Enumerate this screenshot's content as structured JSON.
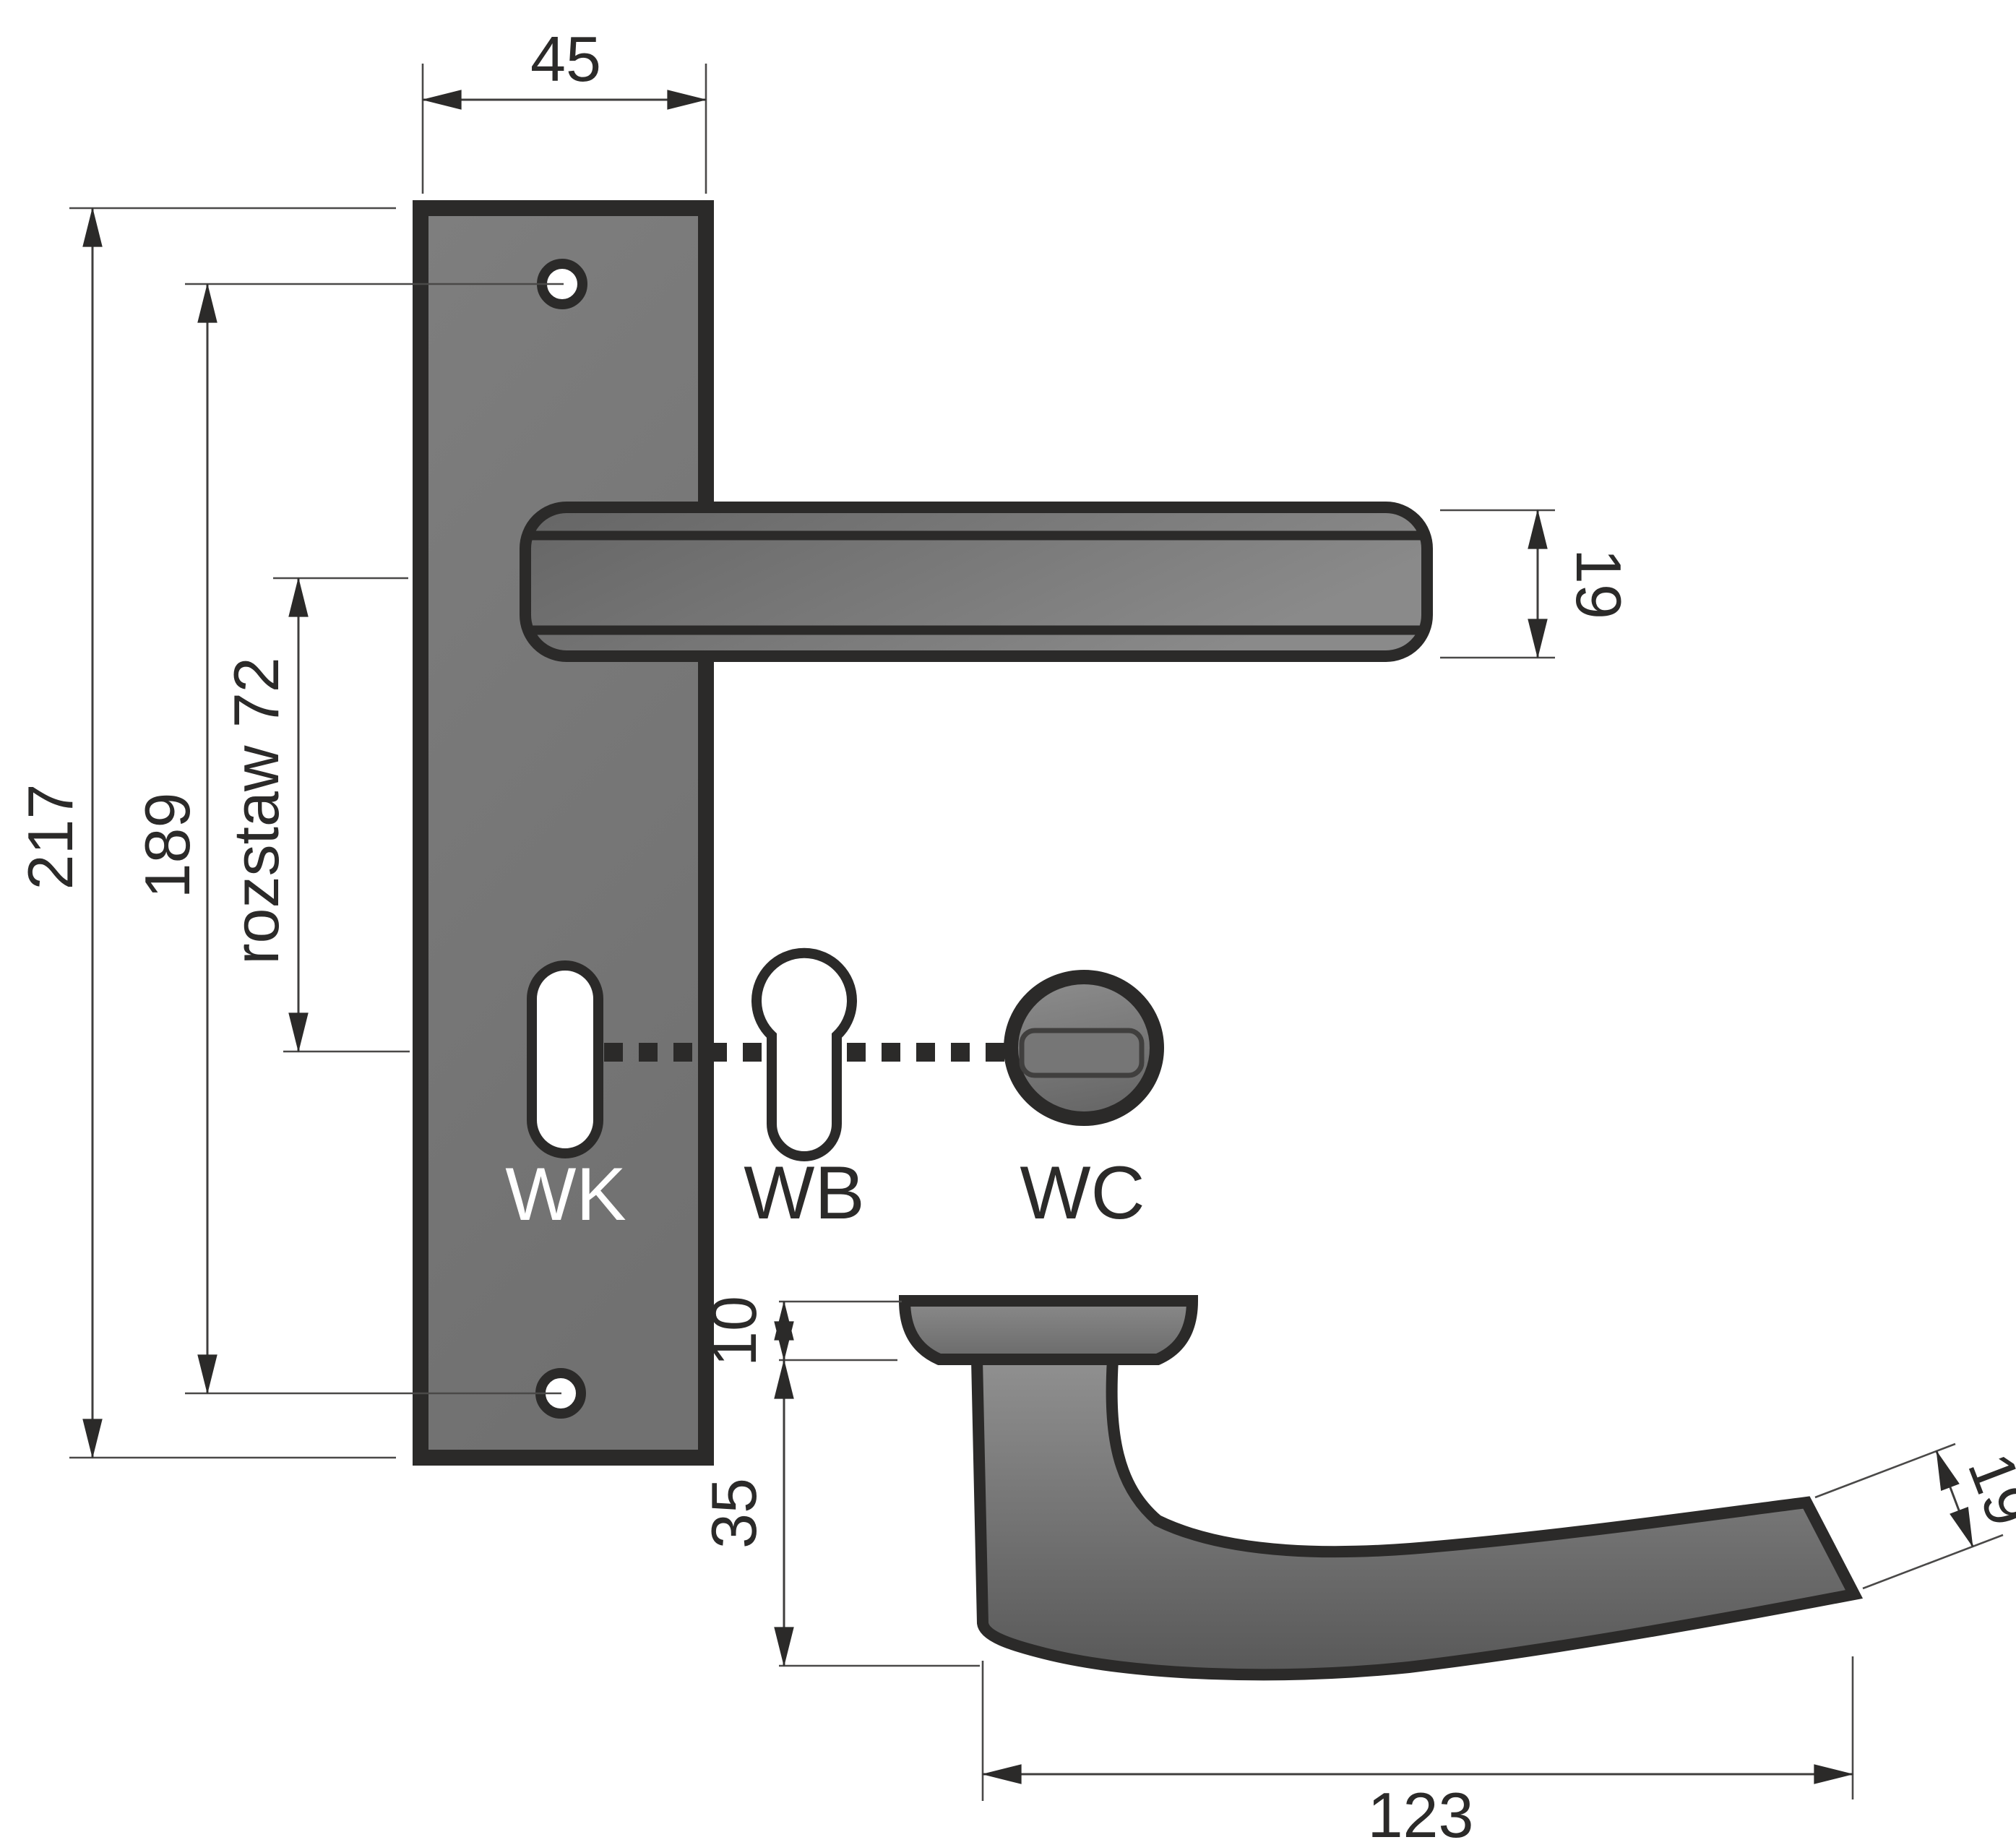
{
  "diagram": {
    "kind": "technical drawing - door handle with backplate, front and side views",
    "variant_labels": {
      "wk": "WK",
      "wb": "WB",
      "wc": "WC"
    },
    "dimensions": {
      "plate_width": "45",
      "plate_total_height": "217",
      "screw_hole_spacing": "189",
      "handle_to_key_axis": "rozstaw 72",
      "lever_bar_thickness": "19",
      "rosette_height": "10",
      "neck_height": "35",
      "handle_projection_length": "123",
      "grip_end_thickness": "19"
    },
    "colors": {
      "background": "#ffffff",
      "outline": "#2b2a29",
      "dimension_line": "#3f3e3d",
      "metal_light": "#8f8f8f",
      "metal_mid": "#787878",
      "metal_dark": "#575757",
      "hole_fill": "#ffffff"
    }
  }
}
